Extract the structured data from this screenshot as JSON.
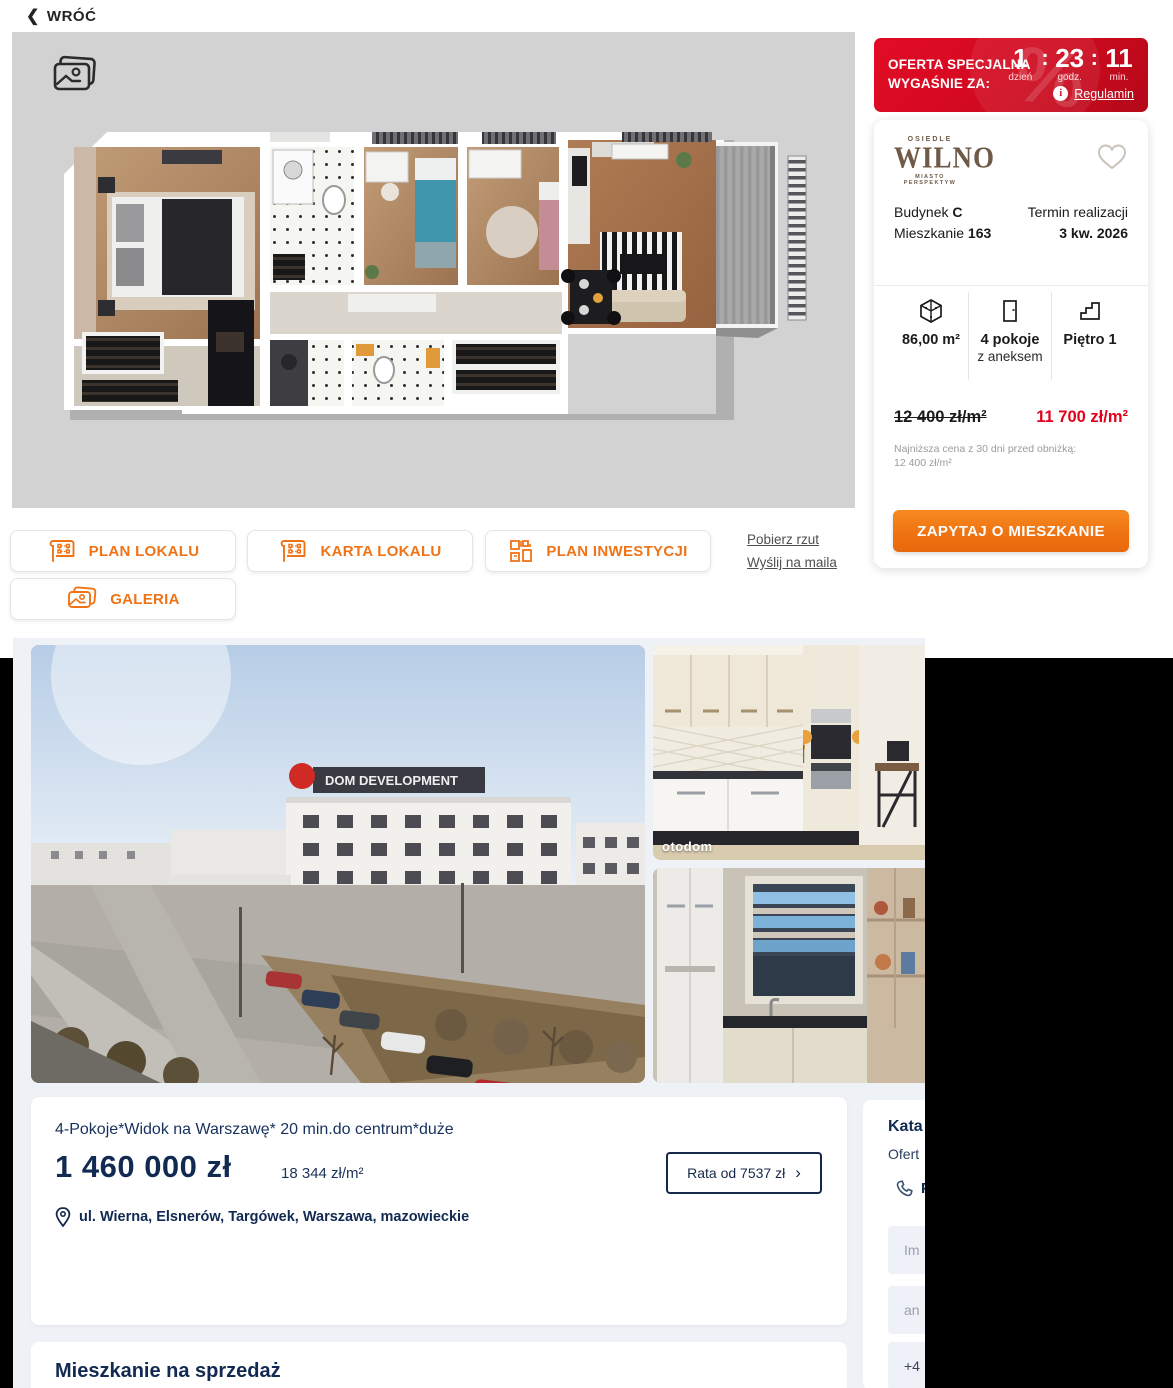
{
  "colors": {
    "accent_orange": "#f07316",
    "sale_red": "#e2001a",
    "navy": "#122a52",
    "brand_brown": "#6e5a47",
    "countdown_red": "#d50f22"
  },
  "back": {
    "label": "WRÓĆ",
    "chevron": "❮"
  },
  "countdown": {
    "line1": "OFERTA SPECJALNA",
    "line2": "WYGAŚNIE ZA:",
    "days": "1",
    "hours": "23",
    "minutes": "11",
    "sep": ":",
    "days_label": "dzień",
    "hours_label": "godz.",
    "minutes_label": "min.",
    "info_glyph": "i",
    "regulamin": "Regulamin"
  },
  "unit_card": {
    "brand_top": "OSIEDLE",
    "brand": "WILNO",
    "brand_sub": "MIASTO PERSPEKTYW",
    "building_label": "Budynek ",
    "building": "C",
    "apartment_label": "Mieszkanie ",
    "apartment": "163",
    "term_label": "Termin realizacji",
    "term": "3 kw. 2026",
    "area": "86,00 m²",
    "rooms": "4 pokoje",
    "rooms_sub": "z aneksem",
    "floor": "Piętro 1",
    "old_price": "12 400 zł/m²",
    "new_price": "11 700 zł/m²",
    "note_line1": "Najniższa cena z 30 dni przed obniżką:",
    "note_line2": "12 400 zł/m²",
    "cta": "ZAPYTAJ O MIESZKANIE"
  },
  "actions": {
    "plan_lokalu": "PLAN LOKALU",
    "karta_lokalu": "KARTA LOKALU",
    "plan_inwestycji": "PLAN INWESTYCJI",
    "galeria": "GALERIA",
    "pobierz_rzut": "Pobierz rzut",
    "wyslij_na_maila": "Wyślij na maila"
  },
  "listing": {
    "title": "4-Pokoje*Widok na Warszawę* 20 min.do centrum*duże",
    "price": "1 460 000 zł",
    "price_per_m2": "18 344 zł/m²",
    "rata_button": "Rata od 7537 zł",
    "rata_chevron": "›",
    "address": "ul. Wierna, Elsnerów, Targówek, Warszawa, mazowieckie",
    "section_title": "Mieszkanie na sprzedaż",
    "photo_watermark": "otodom",
    "photo_sign": "DOM DEVELOPMENT"
  },
  "contact": {
    "name_partial": "Kata",
    "offer_partial": "Ofert",
    "phone_partial": "P",
    "field1_placeholder": "Im",
    "field2_placeholder": "an",
    "field3_value": "+4"
  }
}
